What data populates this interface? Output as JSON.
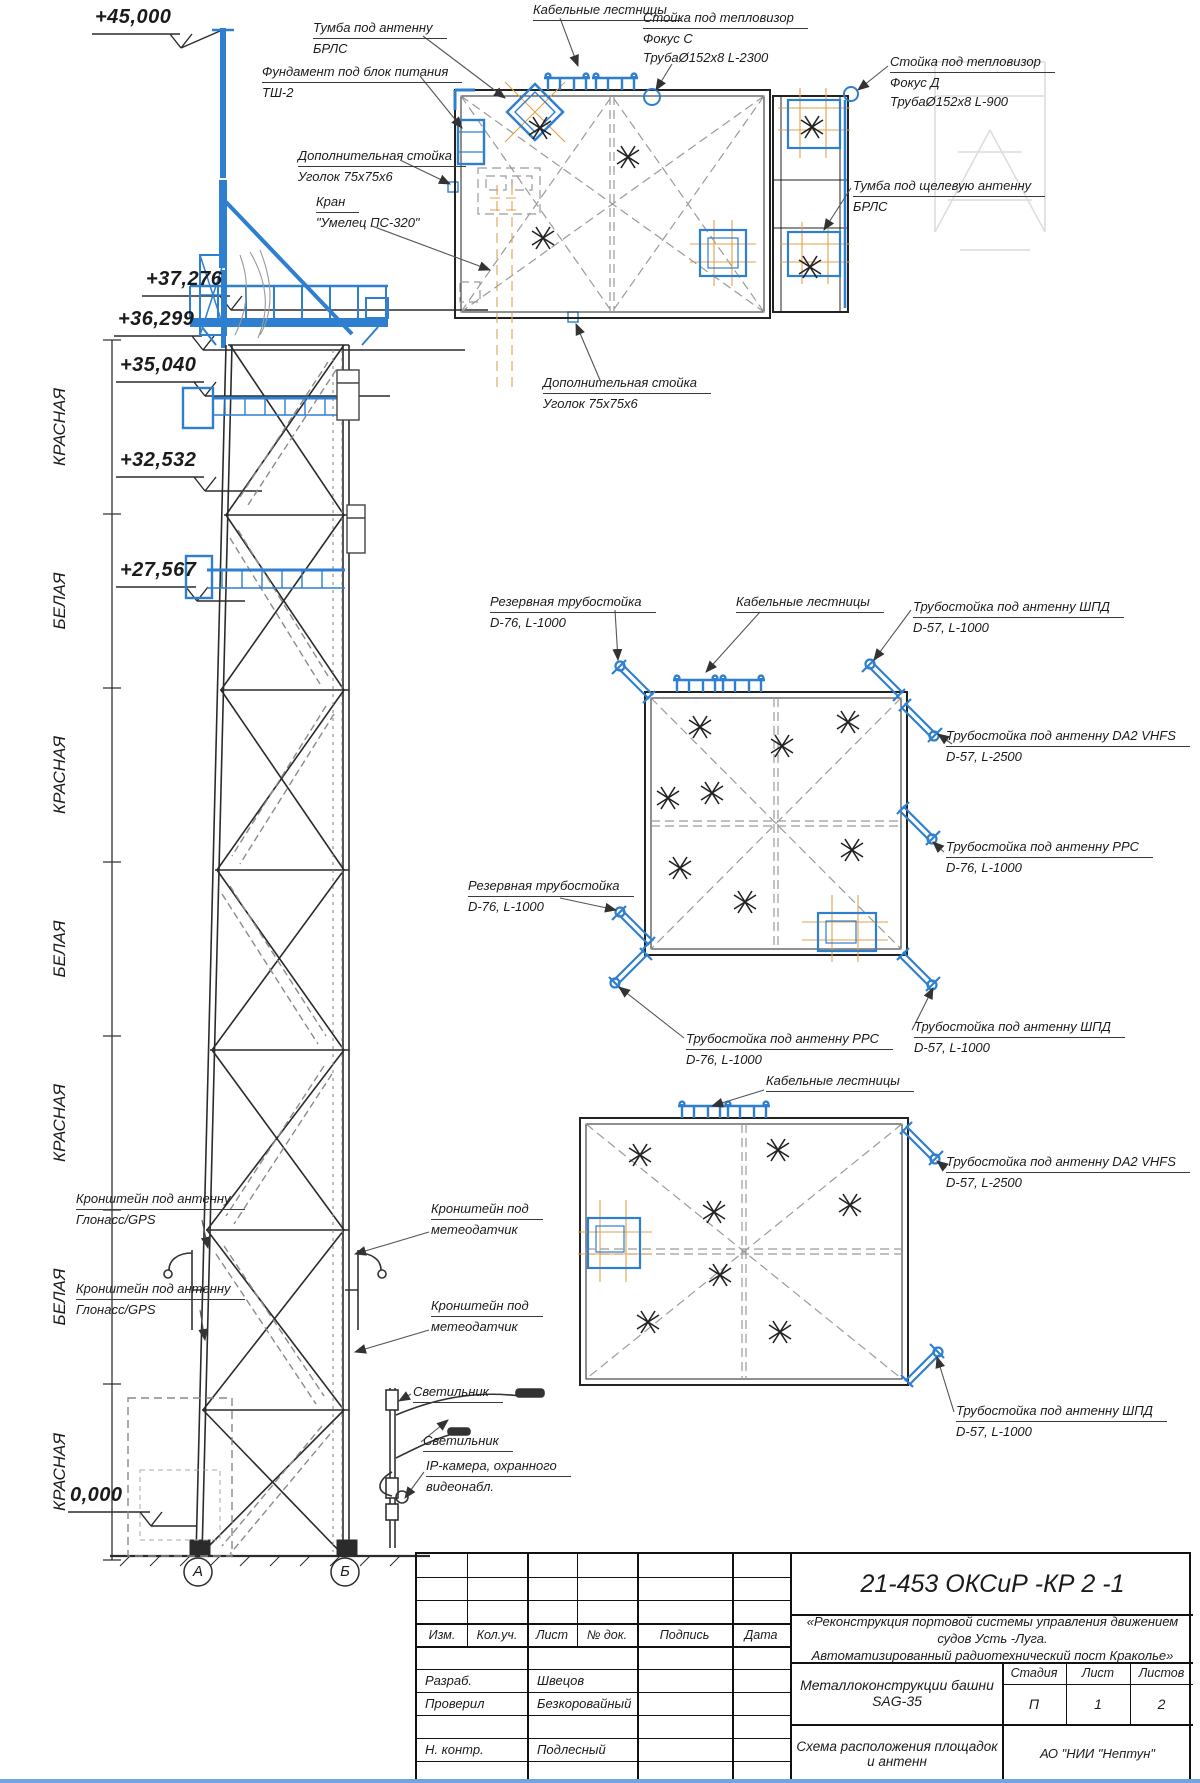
{
  "elevations": [
    "+45,000",
    "+37,276",
    "+36,299",
    "+35,040",
    "+32,532",
    "+27,567",
    "0,000"
  ],
  "bands": [
    "КРАСНАЯ",
    "БЕЛАЯ",
    "КРАСНАЯ",
    "БЕЛАЯ",
    "КРАСНАЯ",
    "БЕЛАЯ",
    "КРАСНАЯ"
  ],
  "axes": [
    "А",
    "Б"
  ],
  "colors": {
    "accent_blue": "#2e7fd0",
    "hatch_orange": "#e2a24b",
    "line_dark": "#2b2b2b"
  },
  "callouts": {
    "cable_ladders": "Кабельные лестницы",
    "lamp": "Светильник",
    "tumba_antenna": {
      "l1": "Тумба под антенну",
      "l2": "БРЛС"
    },
    "foundation": {
      "l1": "Фундамент под блок питания",
      "l2": "ТШ-2"
    },
    "thermal_c": {
      "l1": "Стойка под тепловизор",
      "l2": "Фокус С",
      "l3": "ТрубаØ152x8 L-2300"
    },
    "thermal_d": {
      "l1": "Стойка под тепловизор",
      "l2": "Фокус Д",
      "l3": "ТрубаØ152x8 L-900"
    },
    "extra_post": {
      "l1": "Дополнительная стойка",
      "l2": "Уголок 75х75х6"
    },
    "crane": {
      "l1": "Кран",
      "l2": "\"Умелец ПС-320\""
    },
    "tumba_slot": {
      "l1": "Тумба под щелевую антенну",
      "l2": "БРЛС"
    },
    "reserve_post": {
      "l1": "Резервная трубостойка",
      "l2": "D-76, L-1000"
    },
    "shpd_post": {
      "l1": "Трубостойка под антенну ШПД",
      "l2": "D-57, L-1000"
    },
    "da2_post": {
      "l1": "Трубостойка под антенну DA2 VHFS",
      "l2": "D-57, L-2500"
    },
    "rrs_post": {
      "l1": "Трубостойка под антенну РРС",
      "l2": "D-76, L-1000"
    },
    "gps_bracket": {
      "l1": "Кронштейн под антенну",
      "l2": "Глонасс/GPS"
    },
    "meteo_bracket": {
      "l1": "Кронштейн под",
      "l2": "метеодатчик"
    },
    "ip_camera": {
      "l1": "IP-камера, охранного",
      "l2": "видеонабл."
    }
  },
  "title_block": {
    "doc_number": "21-453 ОКСиР -КР 2 -1",
    "project_line1": "«Реконструкция портовой системы управления движением судов Усть -Луга.",
    "project_line2": "Автоматизированный радиотехнический пост Краколье»",
    "object_name": "Металлоконструкции башни  SAG-35",
    "sheet_title": "Схема расположения площадок и антенн",
    "organization": "АО \"НИИ  \"Нептун\"",
    "stage_label": "Стадия",
    "sheet_label": "Лист",
    "sheets_label": "Листов",
    "stage": "П",
    "sheet_no": "1",
    "sheets_total": "2",
    "cols": [
      "Изм.",
      "Кол.уч.",
      "Лист",
      "№ док.",
      "Подпись",
      "Дата"
    ],
    "rows": [
      {
        "role": "Разраб.",
        "name": "Швецов"
      },
      {
        "role": "Проверил",
        "name": "Безкоровайный"
      },
      {
        "role": "Н. контр.",
        "name": "Подлесный"
      }
    ]
  }
}
